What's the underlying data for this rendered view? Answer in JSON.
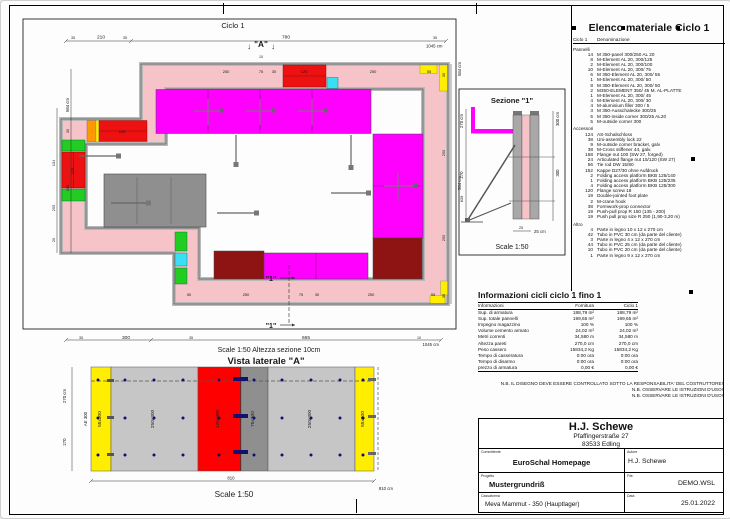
{
  "plan": {
    "title": "Ciclo 1",
    "marker_a_arrow": "↓",
    "marker_a": "\"A\"",
    "marker_a_dim": "10",
    "marker_1": "\"1\"",
    "dims": {
      "top": [
        "35",
        "210",
        "35",
        "780",
        "35"
      ],
      "top_total": "1045 cm",
      "left": [
        "584 cm",
        "30",
        "134",
        "255",
        "20",
        "192"
      ],
      "right_total": "584 cm",
      "right_band": [
        "30",
        "250",
        "250",
        "30"
      ]
    },
    "wall_labels": {
      "top": [
        "250",
        "75",
        "30",
        "125",
        "250",
        "55"
      ],
      "bottom": [
        "50",
        "250",
        "75",
        "30",
        "250",
        "55"
      ],
      "upper_red": "125",
      "left_red": "125"
    }
  },
  "sezione": {
    "title": "Sezione \"1\"",
    "dim_584": "584 cm",
    "left": [
      "270 cm",
      "270",
      "639"
    ],
    "right": [
      "300 cm",
      "300"
    ],
    "tick": "25",
    "bottom": "25 cm",
    "scale": "Scale 1:50"
  },
  "elevation": {
    "chain": [
      "35",
      "300",
      "35",
      "665",
      "10"
    ],
    "chain_total": "1045 cm",
    "pretitle": "Scale 1:50   Altezza sezione 10cm",
    "title": "Vista laterale \"A\"",
    "ae": "AE 300",
    "panels": [
      "55x300",
      "250x300",
      "125x300",
      "75x300",
      "250x300",
      "55x300"
    ],
    "left": [
      "270 cm",
      "270"
    ],
    "bottom": "810",
    "bottom_total": "810 cm",
    "scale": "Scale 1:50"
  },
  "elenco": {
    "title": "Elenco materiale  Ciclo 1",
    "col_qty": "Ciclo 1",
    "col_name": "Denominazione",
    "rows": [
      {
        "kind": "section",
        "qty": "",
        "name": "Pannelli"
      },
      {
        "kind": "item",
        "qty": "14",
        "name": "M 350-panel 300/250 AL 20"
      },
      {
        "kind": "item",
        "qty": "8",
        "name": "M-Element AL 20, 300/125"
      },
      {
        "kind": "item",
        "qty": "2",
        "name": "M-Element AL 20, 300/100"
      },
      {
        "kind": "item",
        "qty": "10",
        "name": "M-Element AL 20, 300/ 75"
      },
      {
        "kind": "item",
        "qty": "6",
        "name": "M 350-Element AL 20, 300/ 55"
      },
      {
        "kind": "item",
        "qty": "1",
        "name": "M-Element AL 20, 300/ 50"
      },
      {
        "kind": "item",
        "qty": "8",
        "name": "M 350-Element AL 20, 300/ 50"
      },
      {
        "kind": "item",
        "qty": "2",
        "name": "M350-ELEMENT  350/ 45 M. AL-PLATTE"
      },
      {
        "kind": "item",
        "qty": "1",
        "name": "M-Element AL 20, 300/ 45"
      },
      {
        "kind": "item",
        "qty": "4",
        "name": "M-Element AL 20, 300/ 30"
      },
      {
        "kind": "item",
        "qty": "4",
        "name": "M-aluminium filler 300 / 5"
      },
      {
        "kind": "item",
        "qty": "3",
        "name": "M 350-Ausschalecke 300/25"
      },
      {
        "kind": "item",
        "qty": "5",
        "name": "M 350-inside corner 300/25 AL20"
      },
      {
        "kind": "item",
        "qty": "5",
        "name": "M-outside corner 300"
      },
      {
        "kind": "section",
        "qty": "",
        "name": "Accessori"
      },
      {
        "kind": "item",
        "qty": "124",
        "name": "AS-Schalschloss"
      },
      {
        "kind": "item",
        "qty": "38",
        "name": "Uni-assembly lock 22"
      },
      {
        "kind": "item",
        "qty": "9",
        "name": "M-outside corner bracket, galv"
      },
      {
        "kind": "item",
        "qty": "38",
        "name": "M-Cross stiffener 44, galv."
      },
      {
        "kind": "item",
        "qty": "168",
        "name": "Flange nut 100 (SW 27, forged)"
      },
      {
        "kind": "item",
        "qty": "24",
        "name": "Articulated flange nut 15/120 (SW 27)"
      },
      {
        "kind": "item",
        "qty": "56",
        "name": "Tie rod DW 15/80"
      },
      {
        "kind": "item",
        "qty": "152",
        "name": "Kappe D27/30 ohne Aufdruck"
      },
      {
        "kind": "item",
        "qty": "2",
        "name": "Folding access platform BKB 125/140"
      },
      {
        "kind": "item",
        "qty": "1",
        "name": "Folding access platform BKB 125/235"
      },
      {
        "kind": "item",
        "qty": "4",
        "name": "Folding access platform BKB 125/300"
      },
      {
        "kind": "item",
        "qty": "120",
        "name": "Flange screw 18"
      },
      {
        "kind": "item",
        "qty": "19",
        "name": "Double-jointed foot plate"
      },
      {
        "kind": "item",
        "qty": "2",
        "name": "M-crane hook"
      },
      {
        "kind": "item",
        "qty": "38",
        "name": "Formwork-prop connector"
      },
      {
        "kind": "item",
        "qty": "19",
        "name": "Push-pull prop R 150 (135 - 200)"
      },
      {
        "kind": "item",
        "qty": "19",
        "name": "Push pull prop size R 250 (1,90-3,20 m)"
      },
      {
        "kind": "section",
        "qty": "",
        "name": "Altro"
      },
      {
        "kind": "item",
        "qty": "4",
        "name": "Parte in legno 10 x 12 x 270 cm"
      },
      {
        "kind": "item",
        "qty": "42",
        "name": "Tubo in PVC 30 cm (da parte del cliente)"
      },
      {
        "kind": "item",
        "qty": "3",
        "name": "Parte in legno 4 x 12 x 270 cm"
      },
      {
        "kind": "item",
        "qty": "44",
        "name": "Tubo in PVC 25 cm (da parte del cliente)"
      },
      {
        "kind": "item",
        "qty": "10",
        "name": "Tubo in PVC 20 cm (da parte del cliente)"
      },
      {
        "kind": "item",
        "qty": "1",
        "name": "Parte in legno 9 x 12 x 270 cm"
      }
    ]
  },
  "info": {
    "title": "Informazioni cicli  ciclo 1 fino 1",
    "col_label": "Informazioni",
    "col_fornitura": "Fornitura",
    "col_ciclo": "Ciclo 1",
    "rows": [
      {
        "label": "Sup. di armatura",
        "fornitura": "188,79 m²",
        "ciclo": "188,79 m²"
      },
      {
        "label": "Sup. totale pannelli",
        "fornitura": "199,65 m²",
        "ciclo": "199,65 m²"
      },
      {
        "label": "Impegno magazzino",
        "fornitura": "100 %",
        "ciclo": "100 %"
      },
      {
        "label": "Volume cemento armato",
        "fornitura": "24,02 m³",
        "ciclo": "24,02 m³"
      },
      {
        "label": "Metri correnti",
        "fornitura": "34,580 m",
        "ciclo": "34,580 m"
      },
      {
        "label": "Altezza pareti",
        "fornitura": "270,0 cm",
        "ciclo": "270,0 cm"
      },
      {
        "label": "Peso cassero",
        "fornitura": "15834,2 Kg",
        "ciclo": "15834,2 Kg"
      },
      {
        "label": "Tempo di casseratura",
        "fornitura": "0:00 ora",
        "ciclo": "0:00 ora"
      },
      {
        "label": "Tempo di disarmo",
        "fornitura": "0:00 ora",
        "ciclo": "0:00 ora"
      },
      {
        "label": "prezzo di armatura",
        "fornitura": "0,00 €",
        "ciclo": "0,00 €"
      }
    ]
  },
  "nb": [
    "N.B. IL DISEGNO DEVE ESSERE CONTROLLATO SOTTO LA RESPONSABILITA' DEL COSTRUTTORE!",
    "N.B. OSSERVARE LE ISTRUZIONI D'USO!",
    "N.B. OSSERVARE LE ISTRUZIONI D'USO!"
  ],
  "titleblock": {
    "company": "H.J. Schewe",
    "street": "Pfaffingerstraße 27",
    "city": "83533 Edling",
    "committente_label": "Committente",
    "committente": "EuroSchal Homepage",
    "autore_label": "Autore",
    "autore": "H.J. Schewe",
    "progetto_label": "Progetto",
    "progetto": "Mustergrundriß",
    "file_label": "File.",
    "file": "DEMO.WSL",
    "cassaforma_label": "Cassaforma",
    "cassaforma": "Meva Mammut - 350 (Hauptlager)",
    "data_label": "Data",
    "data": "25.01.2022"
  },
  "colors": {
    "magenta": "#ff00ff",
    "concrete_pink": "#f6c3c8",
    "formwork_gray": "#b9b9b9",
    "red": "#ee1111",
    "dark_red": "#8e1414",
    "yellow": "#ffee00",
    "green": "#22cc22",
    "cyan": "#39dff2",
    "orange": "#ff9900",
    "interior_gray": "#8f8f8f",
    "tie_blue": "#101070"
  }
}
